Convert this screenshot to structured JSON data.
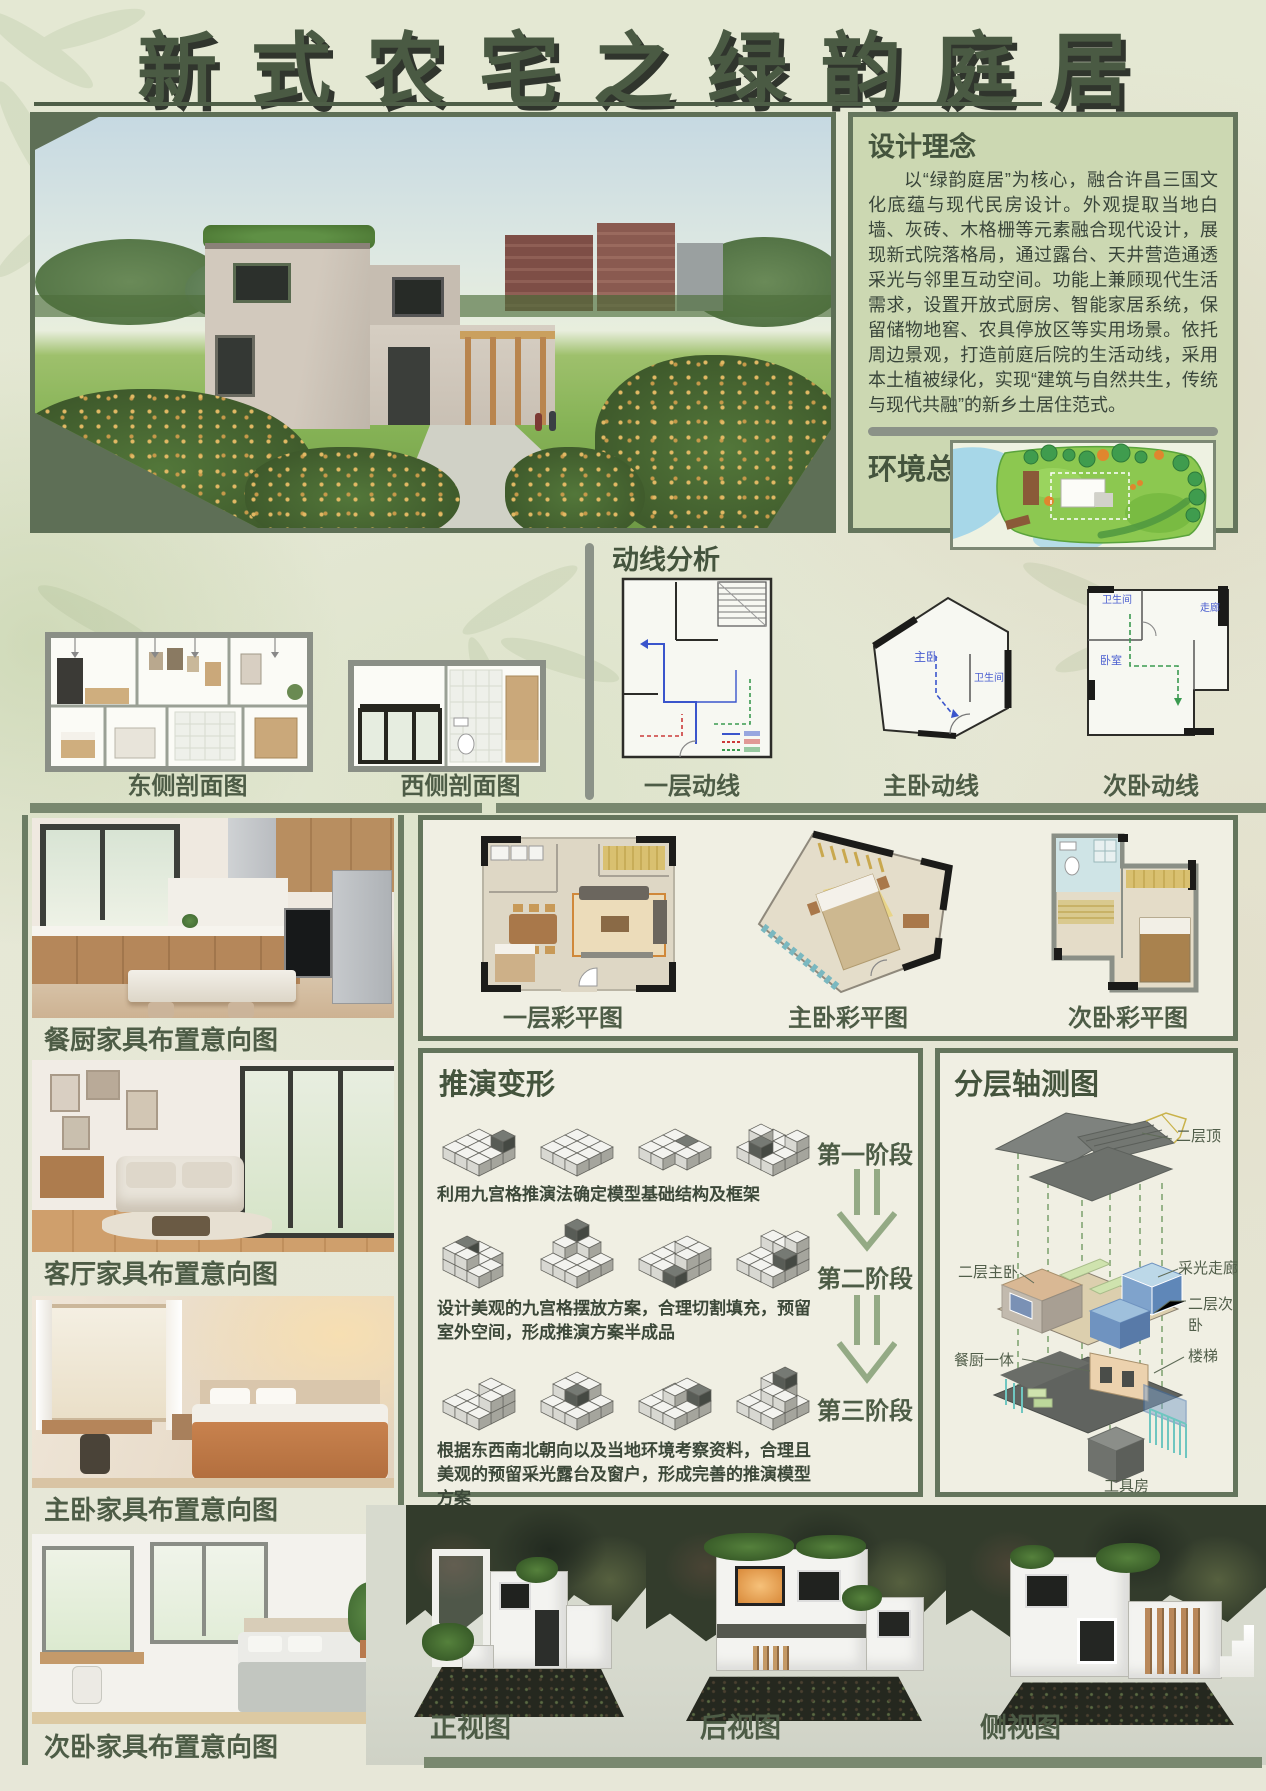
{
  "title": "新式农宅之绿韵庭居",
  "design_concept": {
    "heading": "设计理念",
    "body": "以“绿韵庭居”为核心，融合许昌三国文化底蕴与现代民房设计。外观提取当地白墙、灰砖、木格栅等元素融合现代设计，展现新式院落格局，通过露台、天井营造通透采光与邻里互动空间。功能上兼顾现代生活需求，设置开放式厨房、智能家居系统，保留储物地窖、农具停放区等实用场景。依托周边景观，打造前庭后院的生活动线，采用本土植被绿化，实现“建筑与自然共生，传统与现代共融”的新乡土居住范式。"
  },
  "environment": {
    "heading": "环境总览"
  },
  "sections": {
    "east_caption": "东侧剖面图",
    "west_caption": "西侧剖面图"
  },
  "circulation": {
    "heading": "动线分析",
    "captions": [
      "一层动线",
      "主卧动线",
      "次卧动线"
    ],
    "room_labels": {
      "master": "主卧",
      "master_bath": "卫生间",
      "sub_bath": "卫生间",
      "corridor": "走廊",
      "bedroom": "卧室"
    }
  },
  "color_plans": {
    "captions": [
      "一层彩平图",
      "主卧彩平图",
      "次卧彩平图"
    ]
  },
  "furniture": {
    "captions": [
      "餐厨家具布置意向图",
      "客厅家具布置意向图",
      "主卧家具布置意向图",
      "次卧家具布置意向图"
    ]
  },
  "derivation": {
    "heading": "推演变形",
    "stages": [
      "第一阶段",
      "第二阶段",
      "第三阶段"
    ],
    "notes": [
      "利用九宫格推演法确定模型基础结构及框架",
      "设计美观的九宫格摆放方案，合理切割填充，预留室外空间，形成推演方案半成品",
      "根据东西南北朝向以及当地环境考察资料，合理且美观的预留采光露台及窗户，形成完善的推演模型方案"
    ]
  },
  "axonometric": {
    "heading": "分层轴测图",
    "labels": {
      "roof": "二层顶",
      "master": "二层主卧",
      "light_corridor": "采光走廊",
      "second_bed": "二层次卧",
      "kitchen": "餐厨一体",
      "stairs": "楼梯",
      "tool_room": "工具房"
    }
  },
  "model_views": {
    "captions": [
      "正视图",
      "后视图",
      "侧视图"
    ]
  },
  "colors": {
    "accent_dark": "#64755c",
    "panel_green": "#ccd8b2",
    "bar_gray": "#8b9288",
    "text_green": "#4d5c46",
    "paper": "#f0efe3"
  }
}
